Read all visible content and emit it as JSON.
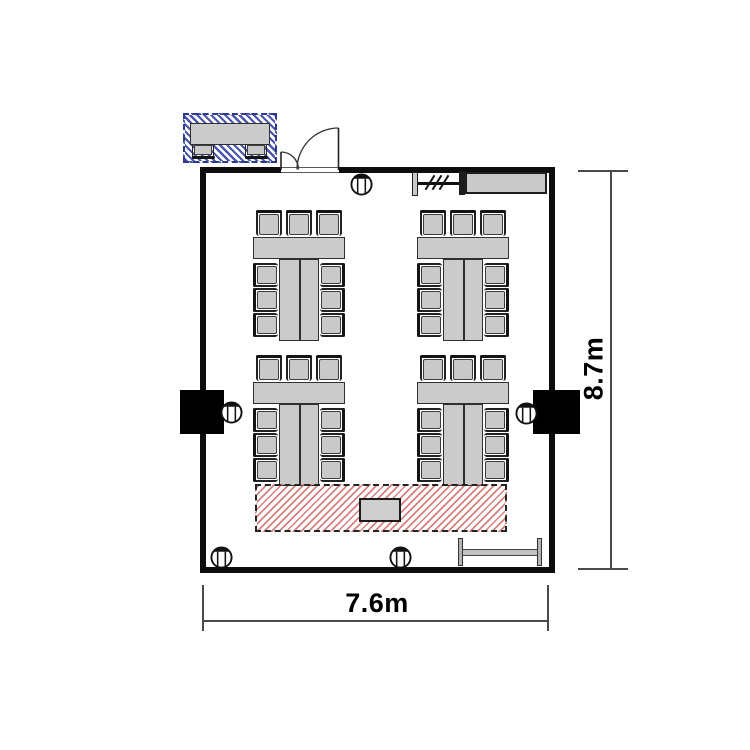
{
  "floor_plan": {
    "dimension_width_label": "7.6m",
    "dimension_height_label": "8.7m",
    "colors": {
      "wall": "#0d0d0d",
      "furniture_fill": "#cbcbcb",
      "furniture_border": "#2f2f2f",
      "stage_hatch_red": "#c95555",
      "reception_hatch_blue": "#3f4da6",
      "pillar_black": "#000000"
    },
    "elements": {
      "table_groups": 4,
      "chairs_per_group": 9,
      "power_outlets": 5,
      "pillars": 2,
      "door": "double-leaf-entrance-door",
      "stage": "hatched-floor-area-with-podium",
      "reception_desk": "hatched-desk-with-2-chairs",
      "wall_cabinet": 1,
      "screen_track": 1,
      "folded_table": 1
    }
  }
}
